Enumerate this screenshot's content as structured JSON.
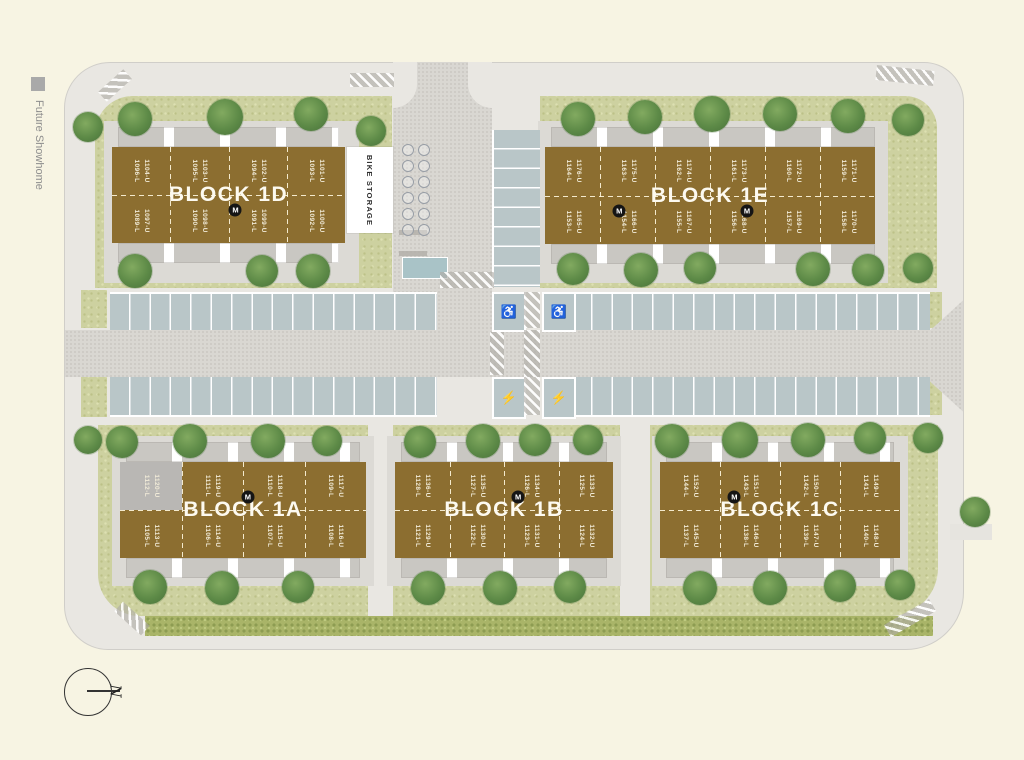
{
  "legend": {
    "future_showhome": "Future Showhome"
  },
  "compass": {
    "north": "N"
  },
  "site": {
    "bike_storage": "BIKE STORAGE"
  },
  "icons": {
    "accessible": "♿",
    "ev": "⚡"
  },
  "colors": {
    "background": "#f7f4e3",
    "pavement": "#e9e7e2",
    "road": "#d9d7d2",
    "lawn": "#cdd1a0",
    "hedge": "#a9b468",
    "parking": "#b9c6c8",
    "building": "#8c6e30",
    "showhome": "#b9b7b4",
    "tree": "#5d8a47",
    "marker": "#151515",
    "unit_text": "#f2ecd9"
  },
  "blocks": [
    {
      "id": "1d",
      "label": "BLOCK 1D",
      "marker": "M",
      "top_units": [
        {
          "upper": "1104-U",
          "lower": "1096-L"
        },
        {
          "upper": "1103-U",
          "lower": "1095-L"
        },
        {
          "upper": "1102-U",
          "lower": "1094-L"
        },
        {
          "upper": "1101-U",
          "lower": "1093-L"
        }
      ],
      "bottom_units": [
        {
          "upper": "1097-U",
          "lower": "1089-L"
        },
        {
          "upper": "1098-U",
          "lower": "1090-L"
        },
        {
          "upper": "1099-U",
          "lower": "1091-L"
        },
        {
          "upper": "1100-U",
          "lower": "1092-L"
        }
      ]
    },
    {
      "id": "1e",
      "label": "BLOCK 1E",
      "marker": "M",
      "top_units": [
        {
          "upper": "1176-U",
          "lower": "1164-L"
        },
        {
          "upper": "1175-U",
          "lower": "1163-L"
        },
        {
          "upper": "1174-U",
          "lower": "1162-L"
        },
        {
          "upper": "1173-U",
          "lower": "1161-L"
        },
        {
          "upper": "1172-U",
          "lower": "1160-L"
        },
        {
          "upper": "1171-U",
          "lower": "1159-L"
        }
      ],
      "bottom_units": [
        {
          "upper": "1165-U",
          "lower": "1153-L"
        },
        {
          "upper": "1166-U",
          "lower": "1154-L"
        },
        {
          "upper": "1167-U",
          "lower": "1155-L"
        },
        {
          "upper": "1168-U",
          "lower": "1156-L"
        },
        {
          "upper": "1169-U",
          "lower": "1157-L"
        },
        {
          "upper": "1170-U",
          "lower": "1158-L"
        }
      ]
    },
    {
      "id": "1a",
      "label": "BLOCK 1A",
      "marker": "M",
      "top_units": [
        {
          "upper": "1120-U",
          "lower": "1112-L",
          "showhome": true
        },
        {
          "upper": "1119-U",
          "lower": "1111-L"
        },
        {
          "upper": "1118-U",
          "lower": "1110-L"
        },
        {
          "upper": "1117-U",
          "lower": "1109-L"
        }
      ],
      "bottom_units": [
        {
          "upper": "1113-U",
          "lower": "1105-L"
        },
        {
          "upper": "1114-U",
          "lower": "1106-L"
        },
        {
          "upper": "1115-U",
          "lower": "1107-L"
        },
        {
          "upper": "1116-U",
          "lower": "1108-L"
        }
      ]
    },
    {
      "id": "1b",
      "label": "BLOCK 1B",
      "marker": "M",
      "top_units": [
        {
          "upper": "1136-U",
          "lower": "1128-L"
        },
        {
          "upper": "1135-U",
          "lower": "1127-L"
        },
        {
          "upper": "1134-U",
          "lower": "1126-L"
        },
        {
          "upper": "1133-U",
          "lower": "1125-L"
        }
      ],
      "bottom_units": [
        {
          "upper": "1129-U",
          "lower": "1121-L"
        },
        {
          "upper": "1130-U",
          "lower": "1122-L"
        },
        {
          "upper": "1131-U",
          "lower": "1123-L"
        },
        {
          "upper": "1132-U",
          "lower": "1124-L"
        }
      ]
    },
    {
      "id": "1c",
      "label": "BLOCK 1C",
      "marker": "M",
      "top_units": [
        {
          "upper": "1152-U",
          "lower": "1144-L"
        },
        {
          "upper": "1151-U",
          "lower": "1143-L"
        },
        {
          "upper": "1150-U",
          "lower": "1142-L"
        },
        {
          "upper": "1149-U",
          "lower": "1141-L"
        }
      ],
      "bottom_units": [
        {
          "upper": "1145-U",
          "lower": "1137-L"
        },
        {
          "upper": "1146-U",
          "lower": "1138-L"
        },
        {
          "upper": "1147-U",
          "lower": "1139-L"
        },
        {
          "upper": "1148-U",
          "lower": "1140-L"
        }
      ]
    }
  ]
}
